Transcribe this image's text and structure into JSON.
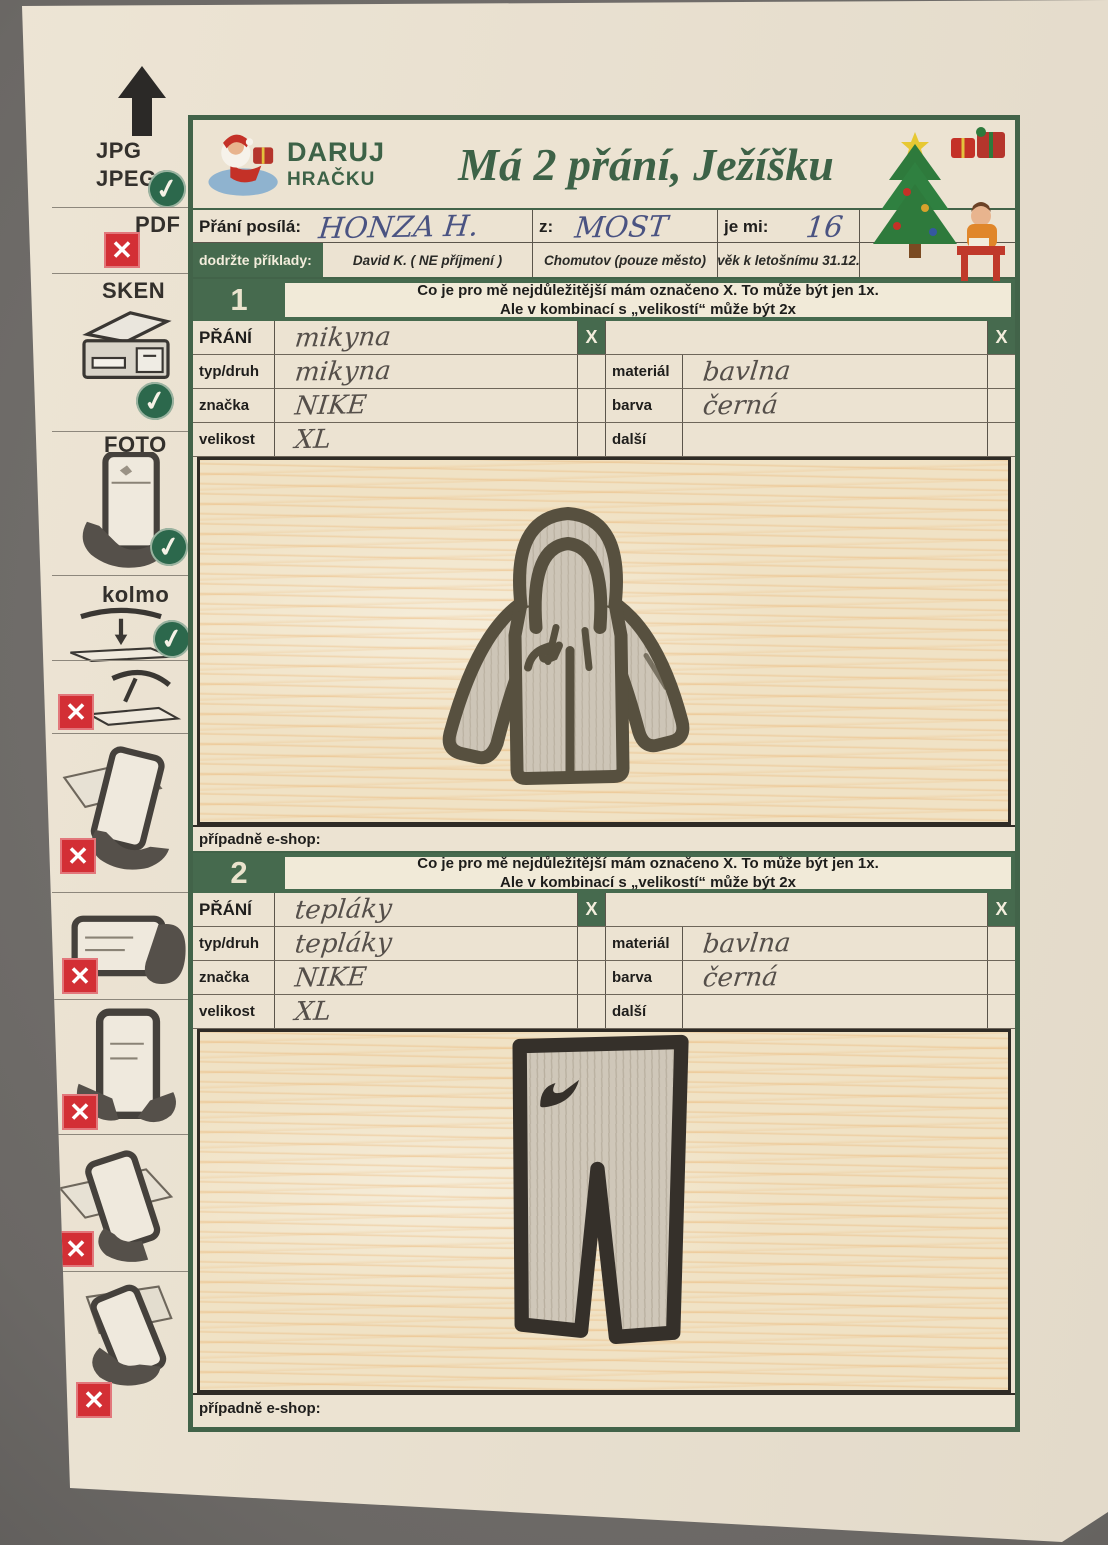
{
  "icons": {
    "check": "✓",
    "cross": "✕"
  },
  "colors": {
    "form_green": "#466a4e",
    "title_green": "#3d6247",
    "reject_red": "#d32f35",
    "ink_blue": "#4a5382",
    "pencil_gray": "#554f4a",
    "paper": "#ece3d2"
  },
  "sidebar": {
    "jpg_line1": "JPG",
    "jpg_line2": "JPEG",
    "pdf_label": "PDF",
    "sken_label": "SKEN",
    "foto_label": "FOTO",
    "kolmo_label": "kolmo",
    "allowed_formats": [
      "JPG/JPEG",
      "SKEN",
      "FOTO",
      "kolmo"
    ],
    "rejected_formats": [
      "PDF",
      "phone-angled-over-paper",
      "phone-in-hand-tilted",
      "phone-landscape-in-hand",
      "phone-portrait-in-hands",
      "phone-tilted-over-paper",
      "phone-above-paper-angled"
    ]
  },
  "form": {
    "logo": {
      "top": "DARUJ",
      "bottom": "HRAČKU"
    },
    "title": "Má 2 přání, Ježíšku",
    "sender": {
      "label": "Přání posílá:",
      "name": "HONZA H.",
      "from_label": "z:",
      "city": "MOST",
      "age_label": "je mi:",
      "age": "16"
    },
    "examples": {
      "label": "dodržte příklady:",
      "name": "David K. ( NE příjmení )",
      "city": "Chomutov  (pouze město)",
      "age": "věk k letošnímu 31.12."
    },
    "instructions": {
      "line1": "Co je pro mě nejdůležitější mám označeno X.  To může být jen 1x.",
      "line2": "Ale v kombinací s „velikostí“ může být 2x"
    },
    "x_header": "X",
    "field_labels": {
      "wish": "PŘÁNÍ",
      "type": "typ/druh",
      "brand": "značka",
      "size": "velikost",
      "material": "materiál",
      "color": "barva",
      "other": "další"
    },
    "eshop_label": "případně e-shop:",
    "sections": [
      {
        "number": "1",
        "wish": "mikyna",
        "type": "mikyna",
        "brand": "NIKE",
        "size": "XL",
        "material": "bavlna",
        "color": "černá",
        "other": "",
        "drawing": "hoodie-sketch"
      },
      {
        "number": "2",
        "wish": "tepláky",
        "type": "tepláky",
        "brand": "NIKE",
        "size": "XL",
        "material": "bavlna",
        "color": "černá",
        "other": "",
        "drawing": "sweatpants-sketch"
      }
    ]
  }
}
